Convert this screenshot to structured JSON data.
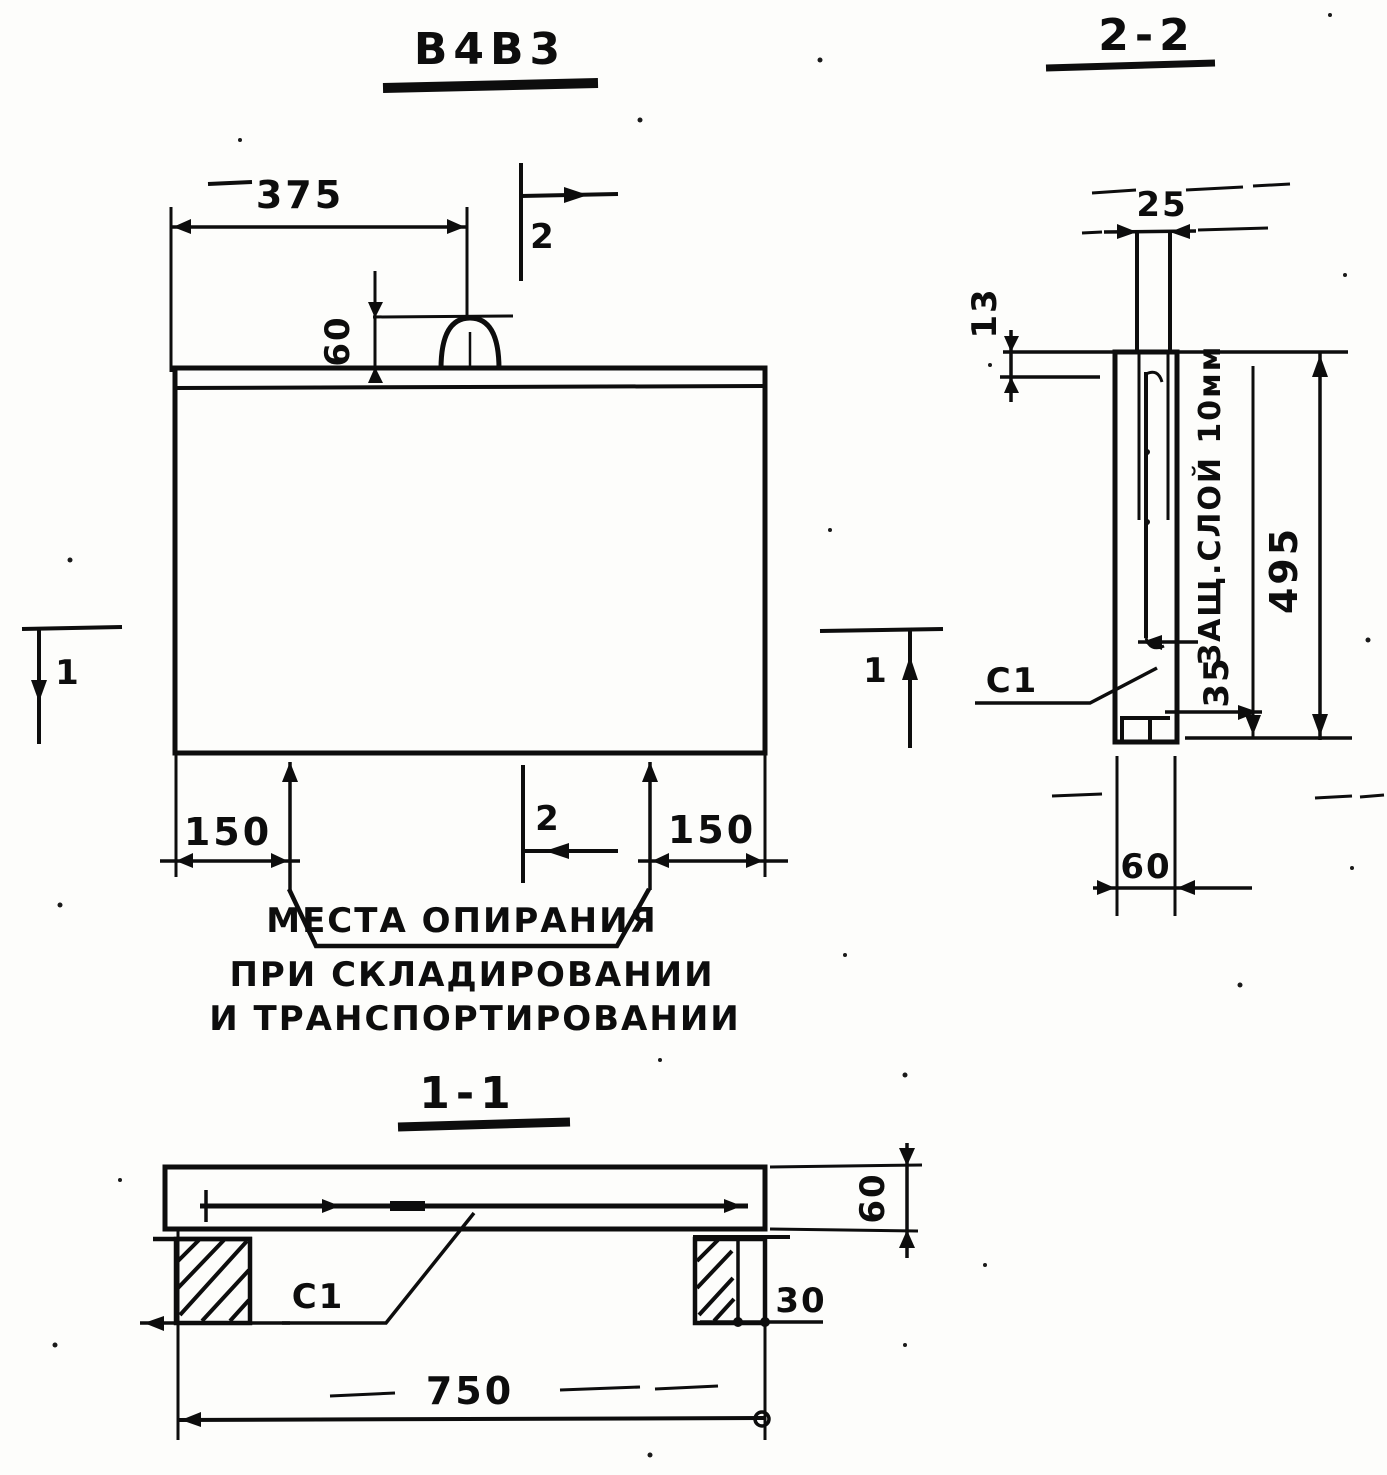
{
  "drawing": {
    "main_view": {
      "title": "В4В3",
      "dim_width_to_loop": "375",
      "dim_loop_height": "60",
      "dim_support_left": "150",
      "dim_support_right": "150",
      "marker_1": "1",
      "marker_2": "2",
      "support_note_line1": "МЕСТА ОПИРАНИЯ",
      "support_note_line2": "ПРИ СКЛАДИРОВАНИИ",
      "support_note_line3": "И ТРАНСПОРТИРОВАНИИ"
    },
    "section_2_2": {
      "title": "2-2",
      "dim_loop_protrusion": "25",
      "dim_top_cover": "13",
      "dim_height": "495",
      "dim_bar_offset": "35",
      "dim_thickness": "60",
      "rebar_label": "С1",
      "cover_note": "ЗАЩ.СЛОЙ 10мм"
    },
    "section_1_1": {
      "title": "1-1",
      "dim_length": "750",
      "dim_thickness": "60",
      "dim_overhang": "30",
      "rebar_label": "С1"
    },
    "ink_color": "#0d0d0d"
  }
}
